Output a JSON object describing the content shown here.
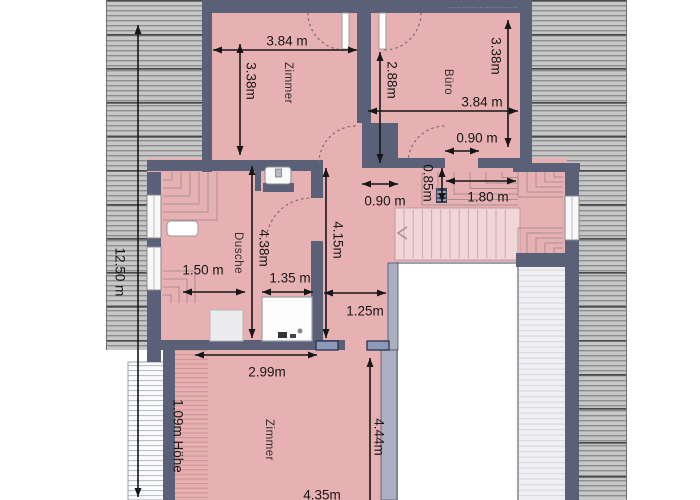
{
  "plan": {
    "type": "floor-plan",
    "colors": {
      "room_pink": "#e7b1b3",
      "stairs_pink": "#f1d6d8",
      "wall_slate": "#5a6078",
      "wall_light": "#aab0c0",
      "hatch_gray": "#c7c7c7",
      "hatch_line": "#8d8d8d",
      "skylight_blue": "#8c9ab9",
      "dimension_ink": "#161616"
    },
    "rooms": [
      {
        "label": "Zimmer"
      },
      {
        "label": "Büro"
      },
      {
        "label": "Dusche"
      },
      {
        "label": "Zimmer"
      }
    ],
    "annotations": {
      "height_note": "1.09m Höhe",
      "watermark": "·····························"
    },
    "dimensions": [
      {
        "label": "3.84 m",
        "x1": 213,
        "y1": 50,
        "x2": 357,
        "y2": 50,
        "lx": 287,
        "ly": 41,
        "rot": 0
      },
      {
        "label": "3.38m",
        "x1": 240,
        "y1": 44,
        "x2": 240,
        "y2": 155,
        "lx": 251,
        "ly": 81,
        "rot": 90
      },
      {
        "label": "2.88m",
        "x1": 380,
        "y1": 52,
        "x2": 380,
        "y2": 163,
        "lx": 392,
        "ly": 80,
        "rot": 90
      },
      {
        "label": "3.38m",
        "x1": 508,
        "y1": 20,
        "x2": 508,
        "y2": 147,
        "lx": 496,
        "ly": 56,
        "rot": 90
      },
      {
        "label": "3.84 m",
        "x1": 368,
        "y1": 111,
        "x2": 518,
        "y2": 111,
        "lx": 482,
        "ly": 102,
        "rot": 0
      },
      {
        "label": "0.90 m",
        "x1": 445,
        "y1": 151,
        "x2": 479,
        "y2": 151,
        "lx": 477,
        "ly": 138,
        "rot": 0
      },
      {
        "label": "0.90 m",
        "x1": 362,
        "y1": 184,
        "x2": 398,
        "y2": 184,
        "lx": 385,
        "ly": 201,
        "rot": 0
      },
      {
        "label": "0.85m",
        "x1": 442,
        "y1": 168,
        "x2": 442,
        "y2": 202,
        "lx": 428,
        "ly": 183,
        "rot": 90
      },
      {
        "label": "1.80 m",
        "x1": 446,
        "y1": 181,
        "x2": 516,
        "y2": 181,
        "lx": 488,
        "ly": 197,
        "rot": 0
      },
      {
        "label": "4.15m",
        "x1": 326,
        "y1": 168,
        "x2": 326,
        "y2": 338,
        "lx": 338,
        "ly": 240,
        "rot": 90
      },
      {
        "label": "4.38m",
        "x1": 252,
        "y1": 166,
        "x2": 252,
        "y2": 338,
        "lx": 264,
        "ly": 248,
        "rot": 90
      },
      {
        "label": "1.50 m",
        "x1": 183,
        "y1": 292,
        "x2": 245,
        "y2": 292,
        "lx": 203,
        "ly": 270,
        "rot": 0
      },
      {
        "label": "1.35 m",
        "x1": 262,
        "y1": 292,
        "x2": 313,
        "y2": 292,
        "lx": 290,
        "ly": 278,
        "rot": 0
      },
      {
        "label": "1.25m",
        "x1": 324,
        "y1": 293,
        "x2": 386,
        "y2": 293,
        "lx": 365,
        "ly": 311,
        "rot": 0
      },
      {
        "label": "2.99m",
        "x1": 195,
        "y1": 355,
        "x2": 317,
        "y2": 355,
        "lx": 267,
        "ly": 372,
        "rot": 0
      },
      {
        "label": "12.50 m",
        "x1": 138,
        "y1": 25,
        "x2": 138,
        "y2": 497,
        "lx": 120,
        "ly": 272,
        "rot": 90
      },
      {
        "label": "4.44m",
        "x1": 370,
        "y1": 358,
        "x2": 370,
        "y2": 500,
        "lx": 379,
        "ly": 437,
        "rot": 90,
        "head2": false
      },
      {
        "label": "4.35m",
        "lx": 322,
        "ly": 495,
        "rot": 0,
        "noline": true
      }
    ]
  }
}
